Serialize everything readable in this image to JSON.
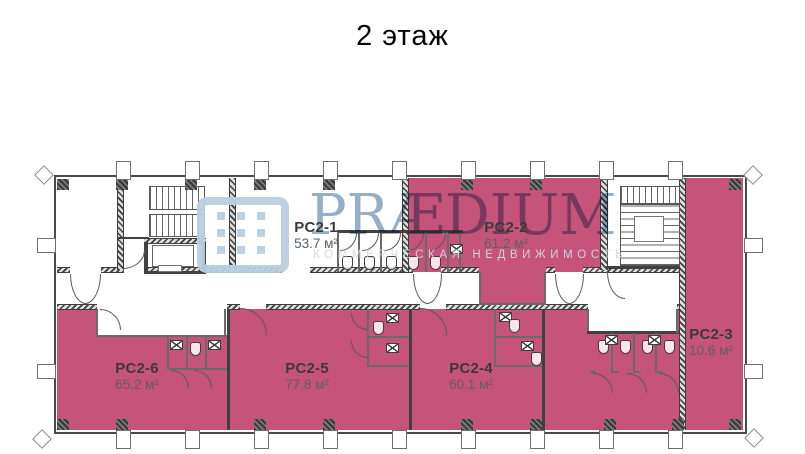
{
  "title": "2 этаж",
  "watermark": {
    "brand": "PRÆDIUM",
    "tagline": "КОММЕРЧЕСКАЯ НЕДВИЖИМОСТЬ"
  },
  "colors": {
    "room_highlight": "#c65379",
    "walls": "#414141",
    "watermark_blue": "#a9c3d8"
  },
  "rooms": [
    {
      "id": "PC2-1",
      "label": "PC2-1",
      "area": "53.7 м²",
      "highlighted": false
    },
    {
      "id": "PC2-2",
      "label": "PC2-2",
      "area": "61.2 м²",
      "highlighted": true
    },
    {
      "id": "PC2-3",
      "label": "PC2-3",
      "area": "10.6 м²",
      "highlighted": true
    },
    {
      "id": "PC2-4",
      "label": "PC2-4",
      "area": "60.1 м²",
      "highlighted": true
    },
    {
      "id": "PC2-5",
      "label": "PC2-5",
      "area": "77.8 м²",
      "highlighted": true
    },
    {
      "id": "PC2-6",
      "label": "PC2-6",
      "area": "65.2 м²",
      "highlighted": true
    }
  ]
}
